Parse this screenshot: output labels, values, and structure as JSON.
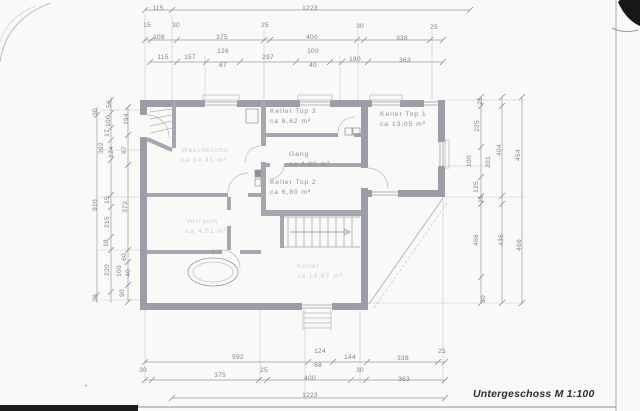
{
  "title": {
    "text": "Untergeschoss M 1:100"
  },
  "rooms": [
    {
      "name": "room-label-keller-top-3",
      "x": 270,
      "y": 107,
      "faint": false,
      "lines": [
        "Keller Top 3",
        "ca 6,62 m²"
      ]
    },
    {
      "name": "room-label-gang",
      "x": 289,
      "y": 150,
      "faint": false,
      "lines": [
        "Gang",
        "ca 4,80 m²"
      ]
    },
    {
      "name": "room-label-keller-top-2",
      "x": 270,
      "y": 178,
      "faint": false,
      "lines": [
        "Keller Top 2",
        "ca 6,80 m²"
      ]
    },
    {
      "name": "room-label-keller-top-1",
      "x": 380,
      "y": 110,
      "faint": false,
      "lines": [
        "Keller Top 1",
        "ca 13,05 m²"
      ]
    },
    {
      "name": "room-label-waschkueche",
      "x": 181,
      "y": 146,
      "faint": true,
      "lines": [
        "Waschküche",
        "ca 14,41 m²"
      ]
    },
    {
      "name": "room-label-vorraum",
      "x": 186,
      "y": 217,
      "faint": true,
      "lines": [
        "Vorraum",
        "ca 4,51 m²"
      ]
    },
    {
      "name": "room-label-keller-mitte",
      "x": 297,
      "y": 262,
      "faint": true,
      "lines": [
        "Keller",
        "ca 14,67 m²"
      ]
    }
  ],
  "dimensions": {
    "top": [
      {
        "t": "115",
        "x": 158,
        "y": 9
      },
      {
        "t": "1223",
        "x": 310,
        "y": 9
      },
      {
        "t": "15",
        "x": 147,
        "y": 26
      },
      {
        "t": "30",
        "x": 176,
        "y": 26
      },
      {
        "t": "25",
        "x": 265,
        "y": 26
      },
      {
        "t": "30",
        "x": 360,
        "y": 27
      },
      {
        "t": "25",
        "x": 434,
        "y": 28
      },
      {
        "t": "108",
        "x": 159,
        "y": 38
      },
      {
        "t": "375",
        "x": 222,
        "y": 38
      },
      {
        "t": "400",
        "x": 312,
        "y": 38
      },
      {
        "t": "338",
        "x": 402,
        "y": 39
      },
      {
        "t": "115",
        "x": 163,
        "y": 58
      },
      {
        "t": "157",
        "x": 190,
        "y": 58
      },
      {
        "t": "126",
        "x": 223,
        "y": 52
      },
      {
        "t": "67",
        "x": 223,
        "y": 66
      },
      {
        "t": "297",
        "x": 268,
        "y": 58
      },
      {
        "t": "100",
        "x": 313,
        "y": 52
      },
      {
        "t": "40",
        "x": 313,
        "y": 66
      },
      {
        "t": "180",
        "x": 355,
        "y": 60
      },
      {
        "t": "363",
        "x": 405,
        "y": 61
      }
    ],
    "bottom": [
      {
        "t": "592",
        "x": 238,
        "y": 358
      },
      {
        "t": "124",
        "x": 320,
        "y": 352
      },
      {
        "t": "144",
        "x": 350,
        "y": 358
      },
      {
        "t": "338",
        "x": 403,
        "y": 359
      },
      {
        "t": "25",
        "x": 442,
        "y": 352
      },
      {
        "t": "30",
        "x": 143,
        "y": 371
      },
      {
        "t": "375",
        "x": 220,
        "y": 376
      },
      {
        "t": "25",
        "x": 264,
        "y": 371
      },
      {
        "t": "68",
        "x": 318,
        "y": 366
      },
      {
        "t": "400",
        "x": 310,
        "y": 379
      },
      {
        "t": "30",
        "x": 360,
        "y": 371
      },
      {
        "t": "363",
        "x": 404,
        "y": 380
      },
      {
        "t": "1223",
        "x": 310,
        "y": 396
      }
    ],
    "left": [
      {
        "t": "30",
        "x": 96,
        "y": 112,
        "r": true
      },
      {
        "t": "920",
        "x": 96,
        "y": 205,
        "r": true
      },
      {
        "t": "30",
        "x": 96,
        "y": 298,
        "r": true
      },
      {
        "t": "56",
        "x": 110,
        "y": 104,
        "r": true
      },
      {
        "t": "100",
        "x": 109,
        "y": 121,
        "r": true
      },
      {
        "t": "17",
        "x": 108,
        "y": 133,
        "r": true
      },
      {
        "t": "392",
        "x": 102,
        "y": 148,
        "r": true
      },
      {
        "t": "124",
        "x": 112,
        "y": 152,
        "r": true
      },
      {
        "t": "15",
        "x": 108,
        "y": 200,
        "r": true
      },
      {
        "t": "215",
        "x": 108,
        "y": 222,
        "r": true
      },
      {
        "t": "18",
        "x": 107,
        "y": 243,
        "r": true
      },
      {
        "t": "220",
        "x": 108,
        "y": 270,
        "r": true
      },
      {
        "t": "194",
        "x": 127,
        "y": 119,
        "r": true
      },
      {
        "t": "67",
        "x": 125,
        "y": 150,
        "r": true
      },
      {
        "t": "373",
        "x": 126,
        "y": 207,
        "r": true
      },
      {
        "t": "60",
        "x": 125,
        "y": 257,
        "r": true
      },
      {
        "t": "100",
        "x": 120,
        "y": 271,
        "r": true
      },
      {
        "t": "40",
        "x": 129,
        "y": 273,
        "r": true
      },
      {
        "t": "90",
        "x": 123,
        "y": 293,
        "r": true
      }
    ],
    "right": [
      {
        "t": "25",
        "x": 481,
        "y": 101,
        "r": true
      },
      {
        "t": "225",
        "x": 478,
        "y": 126,
        "r": true
      },
      {
        "t": "100",
        "x": 470,
        "y": 161,
        "r": true
      },
      {
        "t": "125",
        "x": 477,
        "y": 187,
        "r": true
      },
      {
        "t": "25",
        "x": 482,
        "y": 199,
        "r": true
      },
      {
        "t": "466",
        "x": 477,
        "y": 240,
        "r": true
      },
      {
        "t": "30",
        "x": 484,
        "y": 299,
        "r": true
      },
      {
        "t": "201",
        "x": 489,
        "y": 162,
        "r": true
      },
      {
        "t": "404",
        "x": 500,
        "y": 150,
        "r": true
      },
      {
        "t": "436",
        "x": 502,
        "y": 240,
        "r": true
      },
      {
        "t": "454",
        "x": 519,
        "y": 155,
        "r": true
      },
      {
        "t": "466",
        "x": 520,
        "y": 245,
        "r": true
      }
    ],
    "inner": [
      {
        "t": "375",
        "x": 217,
        "y": 253,
        "f": true
      }
    ]
  },
  "marks": {
    "corner_cross": "+"
  }
}
